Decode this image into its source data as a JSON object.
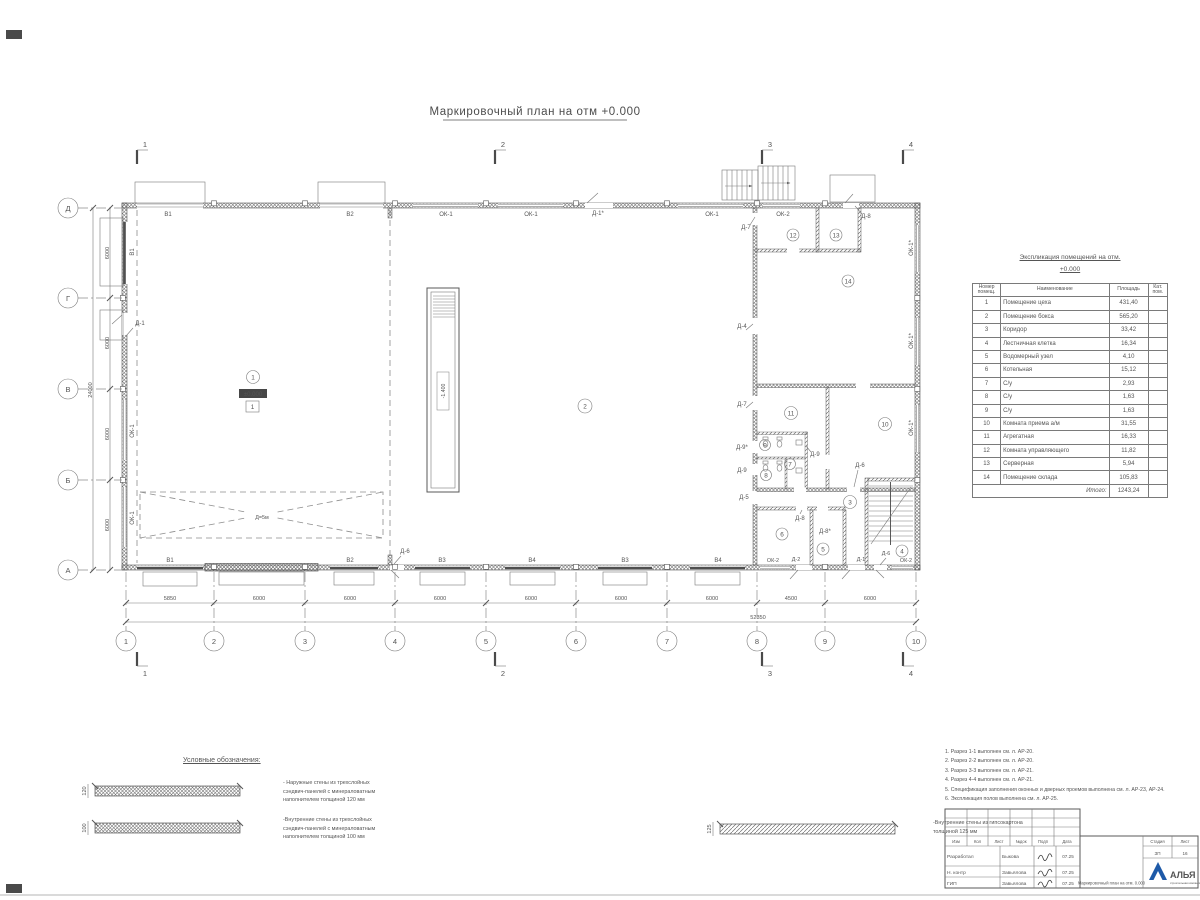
{
  "title": "Маркировочный план на отм +0.000",
  "axes": {
    "cols": [
      "1",
      "2",
      "3",
      "4",
      "5",
      "6",
      "7",
      "8",
      "9",
      "10"
    ],
    "rows": [
      "А",
      "Б",
      "В",
      "Г",
      "Д"
    ]
  },
  "dims": {
    "bottom": [
      "5850",
      "6000",
      "6000",
      "6000",
      "6000",
      "6000",
      "6000",
      "4500",
      "6000"
    ],
    "bottom_total": "52350",
    "left": [
      "6000",
      "6000",
      "6000",
      "6000"
    ],
    "left_total": "24000"
  },
  "sections": [
    "1",
    "2",
    "3",
    "4"
  ],
  "rooms": [
    "1",
    "2",
    "3",
    "4",
    "5",
    "6",
    "7",
    "8",
    "9",
    "10",
    "11",
    "12",
    "13",
    "14"
  ],
  "marks": {
    "zero": "±0.000",
    "floor_type": "1",
    "pit": "-1.400",
    "turn_zone": "Д=5м"
  },
  "labels": {
    "top": [
      "В1",
      "В2",
      "ОК-1",
      "ОК-1",
      "Д-1*",
      "ОК-1",
      "ОК-2",
      "Д-8",
      "Д-7"
    ],
    "bottom": [
      "В1",
      "В2",
      "Д-6",
      "В3",
      "В4",
      "В3",
      "В4",
      "ОК-2",
      "Д-2",
      "Д-1",
      "Д-6",
      "ОК-2"
    ],
    "left": [
      "В1",
      "Д-1",
      "ОК-1",
      "ОК-1"
    ],
    "right": [
      "ОК-1*",
      "ОК-1*",
      "ОК-1*"
    ],
    "interior": [
      "Д-4",
      "Д-7",
      "Д-9*",
      "Д-9",
      "Д-5",
      "Д-9",
      "Д-6",
      "Д-8",
      "Д-8*"
    ]
  },
  "table": {
    "title_line1": "Экспликация помещений на отм.",
    "title_line2": "+0.000",
    "headers": [
      "Номер помещ.",
      "Наименование",
      "Площадь",
      "Кат. пом."
    ],
    "rows": [
      [
        "1",
        "Помещение цеха",
        "431,40"
      ],
      [
        "2",
        "Помещение бокса",
        "565,20"
      ],
      [
        "3",
        "Коридор",
        "33,42"
      ],
      [
        "4",
        "Лестничная клетка",
        "16,34"
      ],
      [
        "5",
        "Водомерный узел",
        "4,10"
      ],
      [
        "6",
        "Котельная",
        "15,12"
      ],
      [
        "7",
        "С/у",
        "2,93"
      ],
      [
        "8",
        "С/у",
        "1,63"
      ],
      [
        "9",
        "С/у",
        "1,63"
      ],
      [
        "10",
        "Комната приема а/м",
        "31,55"
      ],
      [
        "11",
        "Агрегатная",
        "16,33"
      ],
      [
        "12",
        "Комната управляющего",
        "11,82"
      ],
      [
        "13",
        "Серверная",
        "5,94"
      ],
      [
        "14",
        "Помещение склада",
        "105,83"
      ]
    ],
    "total_label": "Итого:",
    "total": "1243,24"
  },
  "legend": {
    "title": "Условные обозначения:",
    "items": [
      {
        "dim": "120",
        "text": "- Наружные стены из трехслойных\nсэндвич-панелей с минераловатным\nнаполнителем толщиной 120 мм"
      },
      {
        "dim": "100",
        "text": "-Внутренние стены из трехслойных\nсэндвич-панелей с минераловатным\nнаполнителем толщиной 100 мм"
      },
      {
        "dim": "125",
        "text": "-Внутренние стены из гипсокартона\nтолщиной 125 мм"
      }
    ]
  },
  "notes": [
    "1. Разрез 1-1 выполнен см. л. АР-20.",
    "2. Разрез 2-2 выполнен см. л. АР-20.",
    "3. Разрез 3-3 выполнен см. л. АР-21.",
    "4. Разрез 4-4 выполнен см. л. АР-21.",
    "5. Спецификация заполнения оконных и дверных проемов выполнена см. л. АР-23, АР-24.",
    "6. Экспликация полов выполнена см. л. АР-25."
  ],
  "titleblock": {
    "header_cols": [
      "Изм",
      "Кол",
      "Лист",
      "№док",
      "Подп",
      "Дата"
    ],
    "rows": [
      {
        "role": "Разработал",
        "name": "Быкова",
        "date": "07.25"
      },
      {
        "role": "Н. контр",
        "name": "Завьялова",
        "date": "07.25"
      },
      {
        "role": "ГИП",
        "name": "Завьялова",
        "date": "07.25"
      }
    ],
    "doc_title": "Маркировочный план на отм. 0.000",
    "stage_label": "Стадия",
    "sheet_label": "Лист",
    "stage": "ЗП",
    "sheet": "16",
    "logo_text": "АЛЬЯ",
    "logo_sub": "строительная компания"
  }
}
